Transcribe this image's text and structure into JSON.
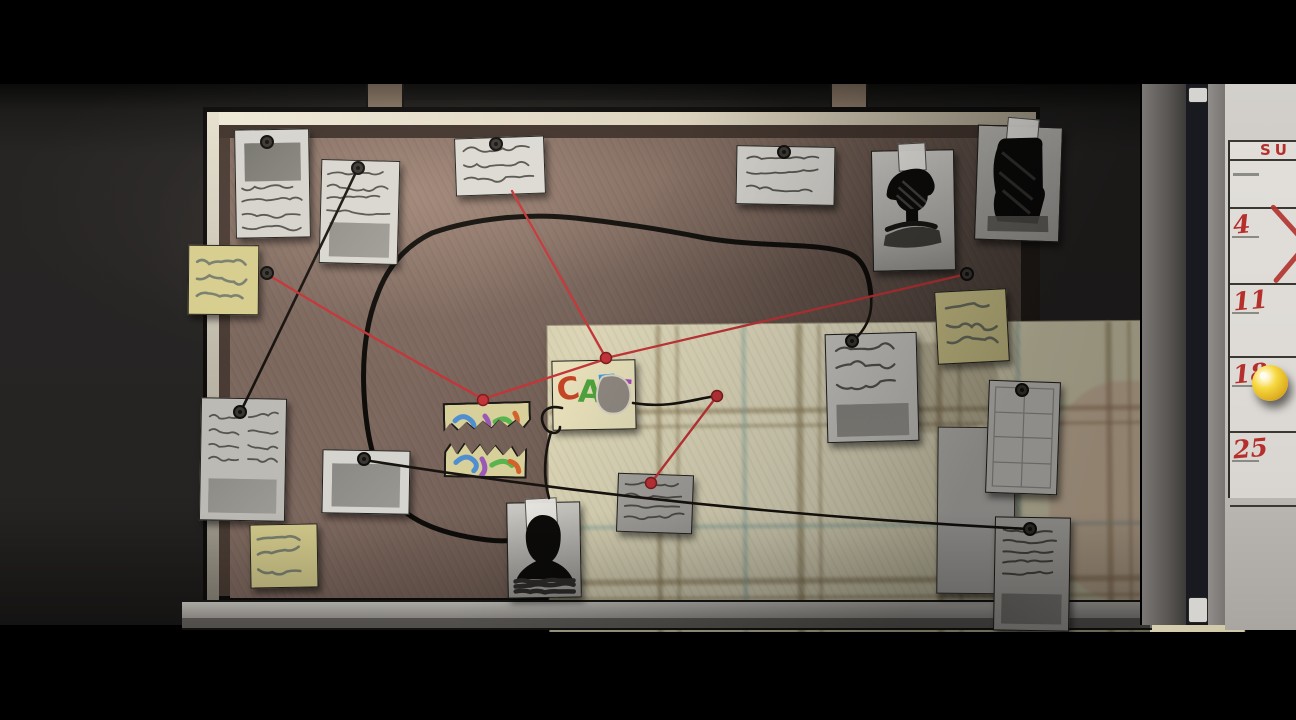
{
  "scene": {
    "description": "dark room with detective cork evidence board, red and black strings, and a wall calendar on a door frame",
    "colors": {
      "string_red": "#c33538",
      "string_black": "#17130f",
      "marker_black": "#0f0d0a",
      "cork": "#6d5a51",
      "sticky_note": "#d6cd8e",
      "calendar_red": "#b5302c",
      "pushpin_yellow": "#f6d83e",
      "map_paper": "#e6dfc0"
    }
  },
  "calendar": {
    "header": "SU",
    "rows": [
      {
        "date": "",
        "mark": "dash",
        "h": 46
      },
      {
        "date": "4",
        "mark": "x",
        "h": 74
      },
      {
        "date": "11",
        "mark": "none",
        "h": 71
      },
      {
        "date": "18",
        "mark": "pushpin",
        "h": 73
      },
      {
        "date": "25",
        "mark": "none",
        "h": 72
      }
    ]
  },
  "cafe_note": {
    "letters": [
      {
        "ch": "C",
        "color": "#c44524",
        "x": 4,
        "y": 13,
        "rot": -8
      },
      {
        "ch": "A",
        "color": "#4ea33c",
        "x": 25,
        "y": 16,
        "rot": 3
      },
      {
        "ch": "F",
        "color": "#3b9bd8",
        "x": 44,
        "y": 11,
        "rot": -4
      },
      {
        "ch": "E",
        "color": "#a349b8",
        "x": 59,
        "y": 16,
        "rot": 6
      }
    ]
  },
  "board": {
    "items": [
      {
        "name": "pinned-note-top-left-1",
        "kind": "note",
        "x": 235,
        "y": 129,
        "w": 73,
        "h": 107,
        "rot": -1,
        "bg": "#d6d4cf",
        "features": [
          {
            "t": "block",
            "x": 9,
            "y": 13,
            "w": 56,
            "h": 38,
            "c": "#77766f"
          },
          {
            "t": "scr",
            "x": 6,
            "y": 58,
            "w": 60,
            "n": 4,
            "gap": 13,
            "amp": 5
          }
        ]
      },
      {
        "name": "pinned-note-top-left-2",
        "kind": "note",
        "x": 320,
        "y": 160,
        "w": 77,
        "h": 102,
        "rot": 1.5,
        "bg": "#d9d7d2",
        "features": [
          {
            "t": "scr",
            "x": 6,
            "y": 14,
            "w": 64,
            "n": 4,
            "gap": 12,
            "amp": 4
          },
          {
            "t": "block",
            "x": 9,
            "y": 62,
            "w": 60,
            "h": 34,
            "c": "#92908a"
          }
        ]
      },
      {
        "name": "pinned-note-top-center",
        "kind": "note",
        "x": 455,
        "y": 137,
        "w": 88,
        "h": 56,
        "rot": -2,
        "bg": "#dcdad5",
        "features": [
          {
            "t": "scr",
            "x": 8,
            "y": 12,
            "w": 72,
            "n": 3,
            "gap": 14,
            "amp": 6
          }
        ]
      },
      {
        "name": "pinned-note-top-right",
        "kind": "note",
        "x": 736,
        "y": 146,
        "w": 97,
        "h": 57,
        "rot": 1,
        "bg": "#d4d2cd",
        "features": [
          {
            "t": "scr",
            "x": 10,
            "y": 12,
            "w": 76,
            "n": 3,
            "gap": 14,
            "amp": 5
          }
        ]
      },
      {
        "name": "suspect-photo-hat",
        "kind": "note",
        "x": 872,
        "y": 150,
        "w": 81,
        "h": 119,
        "rot": -1,
        "bg": "linear-gradient(180deg,#cdcbc7,#b4b2ae 70%,#9a9894)",
        "features": [
          {
            "t": "sil",
            "v": "hat"
          },
          {
            "t": "tape",
            "x": 26,
            "y": -8,
            "w": 26,
            "h": 26
          }
        ]
      },
      {
        "name": "suspect-photo-figure",
        "kind": "note",
        "x": 976,
        "y": 126,
        "w": 83,
        "h": 113,
        "rot": 2,
        "bg": "linear-gradient(180deg,#bab8b4,#a5a39f)",
        "features": [
          {
            "t": "sil",
            "v": "figure"
          },
          {
            "t": "tape",
            "x": 28,
            "y": -9,
            "w": 30,
            "h": 22
          }
        ]
      },
      {
        "name": "sticky-note-left-top",
        "kind": "sticky",
        "x": 188,
        "y": 245,
        "w": 69,
        "h": 68,
        "rot": 0.5,
        "bg": "#d6cd8e",
        "features": [
          {
            "t": "scr",
            "x": 8,
            "y": 16,
            "w": 52,
            "n": 3,
            "gap": 17,
            "amp": 7,
            "c": "#79806f",
            "lw": 2.6
          }
        ]
      },
      {
        "name": "pinned-note-left",
        "kind": "note",
        "x": 200,
        "y": 398,
        "w": 84,
        "h": 121,
        "rot": 1,
        "bg": "#bcbab5",
        "features": [
          {
            "t": "scr",
            "x": 8,
            "y": 18,
            "w": 68,
            "n": 4,
            "gap": 14,
            "amp": 5,
            "cols": 2
          },
          {
            "t": "block",
            "x": 8,
            "y": 80,
            "w": 68,
            "h": 34,
            "c": "#8e8c87"
          }
        ]
      },
      {
        "name": "sticky-note-left-bottom",
        "kind": "sticky",
        "x": 250,
        "y": 524,
        "w": 66,
        "h": 62,
        "rot": -1,
        "bg": "#d2c98b",
        "features": [
          {
            "t": "scr",
            "x": 7,
            "y": 14,
            "w": 50,
            "n": 3,
            "gap": 15,
            "amp": 7,
            "c": "#79806f",
            "lw": 2.6
          }
        ]
      },
      {
        "name": "polaroid-photo",
        "kind": "note",
        "x": 322,
        "y": 450,
        "w": 86,
        "h": 62,
        "rot": 1,
        "bg": "#d6d4cf",
        "features": [
          {
            "t": "block",
            "x": 9,
            "y": 13,
            "w": 68,
            "h": 43,
            "c": "#8b8984"
          }
        ]
      },
      {
        "name": "torn-colorful-strip-top",
        "kind": "strip",
        "x": 443,
        "y": 402,
        "w": 88,
        "h": 34,
        "rot": -1.5,
        "bg": "#d7d09b",
        "jag": "bottom",
        "features": [
          {
            "t": "strokes",
            "set": "a"
          }
        ]
      },
      {
        "name": "torn-colorful-strip-bottom",
        "kind": "strip",
        "x": 444,
        "y": 439,
        "w": 83,
        "h": 39,
        "rot": 1,
        "bg": "#d7d09b",
        "jag": "top",
        "features": [
          {
            "t": "strokes",
            "set": "b"
          }
        ]
      },
      {
        "name": "cafe-note",
        "kind": "note",
        "x": 552,
        "y": 360,
        "w": 82,
        "h": 68,
        "rot": -1,
        "bg": "#e6dfb9",
        "features": [
          {
            "t": "letters"
          },
          {
            "t": "torn"
          }
        ]
      },
      {
        "name": "pinned-note-right",
        "kind": "note",
        "x": 826,
        "y": 333,
        "w": 90,
        "h": 107,
        "rot": -1.5,
        "bg": "#cfcdc8",
        "features": [
          {
            "t": "scr",
            "x": 10,
            "y": 16,
            "w": 70,
            "n": 3,
            "gap": 17,
            "amp": 8,
            "lw": 2.2
          },
          {
            "t": "block",
            "x": 9,
            "y": 70,
            "w": 72,
            "h": 32,
            "c": "#8e8c86"
          }
        ]
      },
      {
        "name": "sticky-note-right",
        "kind": "sticky",
        "x": 936,
        "y": 290,
        "w": 70,
        "h": 71,
        "rot": -3,
        "bg": "#d2c88c",
        "features": [
          {
            "t": "scr",
            "x": 10,
            "y": 16,
            "w": 50,
            "n": 3,
            "gap": 17,
            "amp": 7,
            "c": "#6e7363",
            "lw": 2.6
          }
        ]
      },
      {
        "name": "blank-paper-panel",
        "kind": "panel",
        "x": 937,
        "y": 427,
        "w": 76,
        "h": 165,
        "rot": 0.5,
        "bg": "#c3c1bd",
        "features": []
      },
      {
        "name": "grid-paper",
        "kind": "note",
        "x": 987,
        "y": 381,
        "w": 70,
        "h": 111,
        "rot": 2,
        "bg": "#d2d0cb",
        "features": [
          {
            "t": "grid"
          }
        ]
      },
      {
        "name": "pinned-note-bottom-right",
        "kind": "note",
        "x": 994,
        "y": 517,
        "w": 74,
        "h": 112,
        "rot": 1,
        "bg": "#c6c4bf",
        "features": [
          {
            "t": "scr",
            "x": 8,
            "y": 12,
            "w": 58,
            "n": 5,
            "gap": 11,
            "amp": 3,
            "lw": 2
          },
          {
            "t": "block",
            "x": 7,
            "y": 76,
            "w": 60,
            "h": 30,
            "c": "#8a8883"
          }
        ]
      },
      {
        "name": "silhouette-photo",
        "kind": "note",
        "x": 507,
        "y": 502,
        "w": 72,
        "h": 94,
        "rot": -1,
        "bg": "linear-gradient(180deg,#cbc9c4,#a09e9a)",
        "features": [
          {
            "t": "sil",
            "v": "bust"
          },
          {
            "t": "tape",
            "x": 18,
            "y": -5,
            "w": 30,
            "h": 29
          }
        ]
      },
      {
        "name": "pinned-note-bottom-small",
        "kind": "note",
        "x": 617,
        "y": 474,
        "w": 74,
        "h": 57,
        "rot": 2,
        "bg": "#a8a6a1",
        "features": [
          {
            "t": "scr",
            "x": 7,
            "y": 10,
            "w": 60,
            "n": 4,
            "gap": 11,
            "amp": 4,
            "c": "#504e49"
          }
        ]
      }
    ]
  },
  "pins": {
    "dark": [
      [
        267,
        142
      ],
      [
        358,
        168
      ],
      [
        496,
        144
      ],
      [
        784,
        152
      ],
      [
        240,
        412
      ],
      [
        267,
        273
      ],
      [
        967,
        274
      ],
      [
        852,
        341
      ],
      [
        1022,
        390
      ],
      [
        364,
        459
      ],
      [
        1030,
        529
      ]
    ],
    "red": [
      [
        483,
        400
      ],
      [
        606,
        358
      ],
      [
        717,
        396
      ],
      [
        651,
        483
      ]
    ]
  },
  "strings": {
    "red": [
      "M267,274 Q375,340 483,399",
      "M483,399 L606,359",
      "M606,358 L512,191",
      "M606,358 L967,274",
      "M717,396 L651,483"
    ],
    "black": [
      "M357,170 Q300,290 241,411",
      "M364,460 Q690,512 1029,529",
      "M562,408 C546,404 538,414 544,426 C548,435 560,435 560,427",
      "M551,432 C544,455 543,477 549,498",
      "M633,403 C668,409 694,399 716,396",
      "M871,296 C873,318 864,331 853,341"
    ],
    "marker_loop": [
      "M432,233 C475,218 530,213 575,218 C630,224 670,231 705,238 C765,248 815,242 848,253 C862,258 869,272 871,296",
      "M432,233 C407,245 389,264 378,293 C367,320 362,354 364,393 C366,432 373,467 391,497 C409,523 446,535 488,540 C514,543 534,538 546,526 C551,521 549,508 545,500"
    ]
  }
}
